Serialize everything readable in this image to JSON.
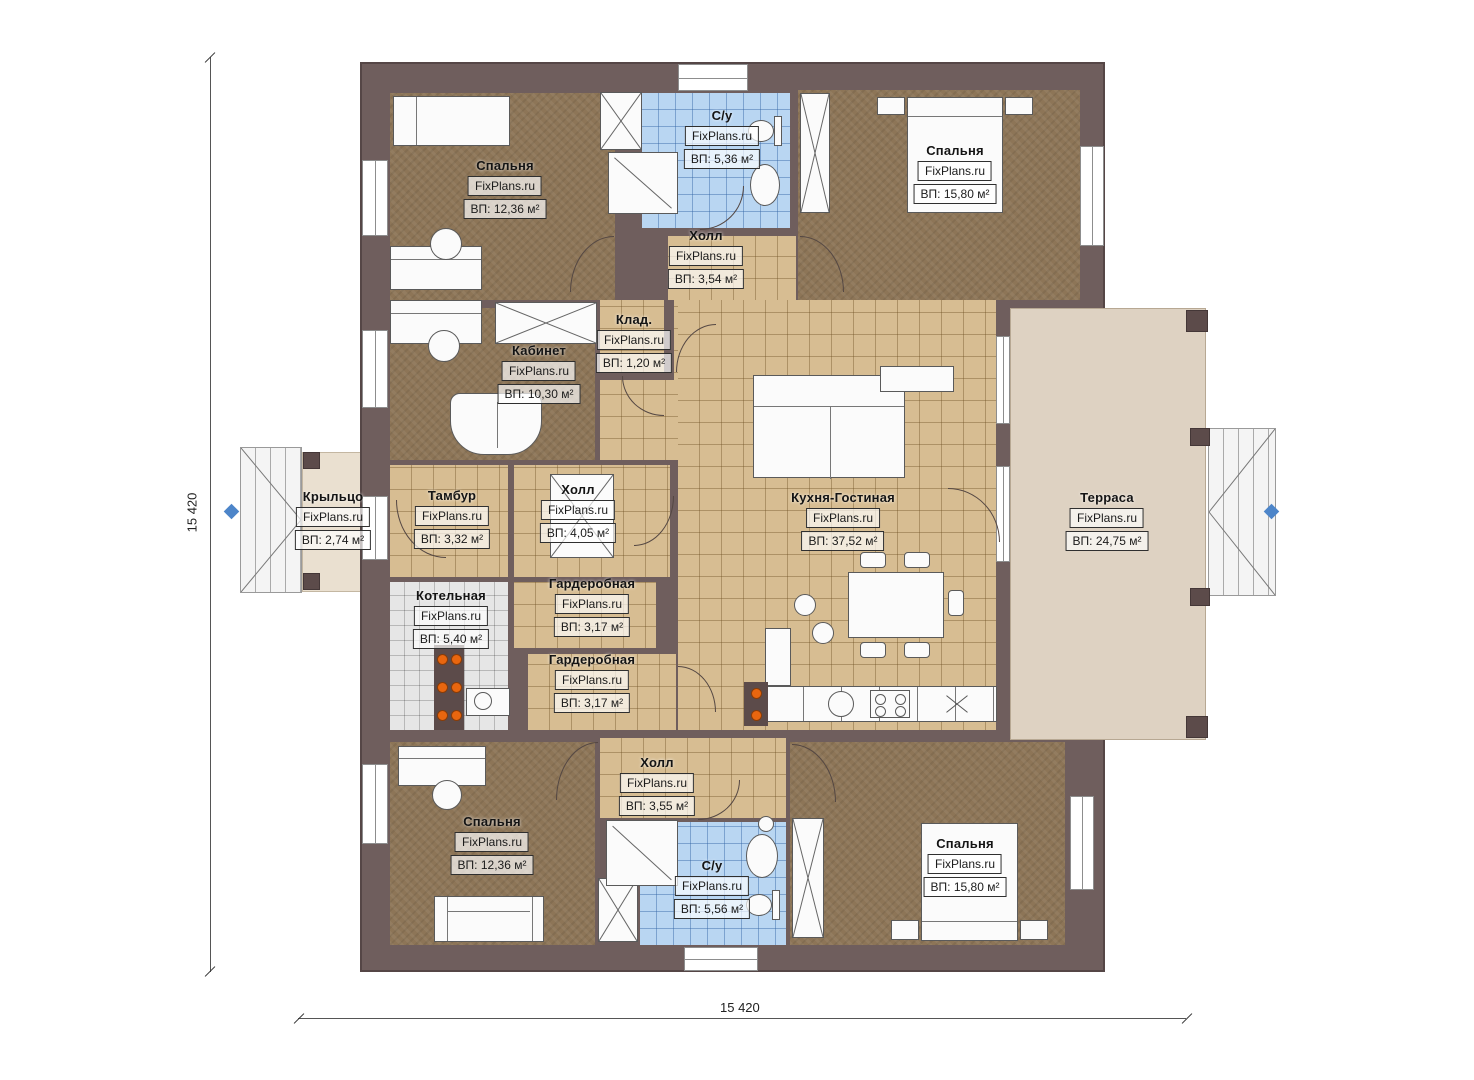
{
  "meta": {
    "watermark": "FixPlans.ru",
    "plan_type": "floor-plan"
  },
  "dims": {
    "width_label": "15 420",
    "height_label": "15 420"
  },
  "colors": {
    "wall": "#6f5e5d",
    "bedroom_floor": "#8d7557",
    "tile_floor": "#d7bd92",
    "bath_floor": "#b9d6f2",
    "boiler_floor": "#e6e6e6",
    "terrace": "#ded2c2",
    "porch": "#eae0d0",
    "marker_blue": "#4d85c9",
    "equipment_orange": "#e8660f"
  },
  "rooms": [
    {
      "id": "bedroom-top-left",
      "name": "Спальня",
      "area": "ВП: 12,36 м²"
    },
    {
      "id": "bathroom-top",
      "name": "С/у",
      "area": "ВП: 5,36 м²"
    },
    {
      "id": "bedroom-top-right",
      "name": "Спальня",
      "area": "ВП: 15,80 м²"
    },
    {
      "id": "hall-top",
      "name": "Холл",
      "area": "ВП: 3,54 м²"
    },
    {
      "id": "pantry",
      "name": "Клад.",
      "area": "ВП: 1,20 м²"
    },
    {
      "id": "office",
      "name": "Кабинет",
      "area": "ВП: 10,30 м²"
    },
    {
      "id": "porch",
      "name": "Крыльцо",
      "area": "ВП: 2,74 м²"
    },
    {
      "id": "vestibule",
      "name": "Тамбур",
      "area": "ВП: 3,32 м²"
    },
    {
      "id": "hall-middle",
      "name": "Холл",
      "area": "ВП: 4,05 м²"
    },
    {
      "id": "kitchen-living",
      "name": "Кухня-Гостиная",
      "area": "ВП: 37,52 м²"
    },
    {
      "id": "terrace",
      "name": "Терраса",
      "area": "ВП: 24,75 м²"
    },
    {
      "id": "boiler-room",
      "name": "Котельная",
      "area": "ВП: 5,40 м²"
    },
    {
      "id": "wardrobe-upper",
      "name": "Гардеробная",
      "area": "ВП: 3,17 м²"
    },
    {
      "id": "wardrobe-lower",
      "name": "Гардеробная",
      "area": "ВП: 3,17 м²"
    },
    {
      "id": "hall-bottom",
      "name": "Холл",
      "area": "ВП: 3,55 м²"
    },
    {
      "id": "bedroom-bottom-left",
      "name": "Спальня",
      "area": "ВП: 12,36 м²"
    },
    {
      "id": "bathroom-bottom",
      "name": "С/у",
      "area": "ВП: 5,56 м²"
    },
    {
      "id": "bedroom-bottom-right",
      "name": "Спальня",
      "area": "ВП: 15,80 м²"
    }
  ]
}
